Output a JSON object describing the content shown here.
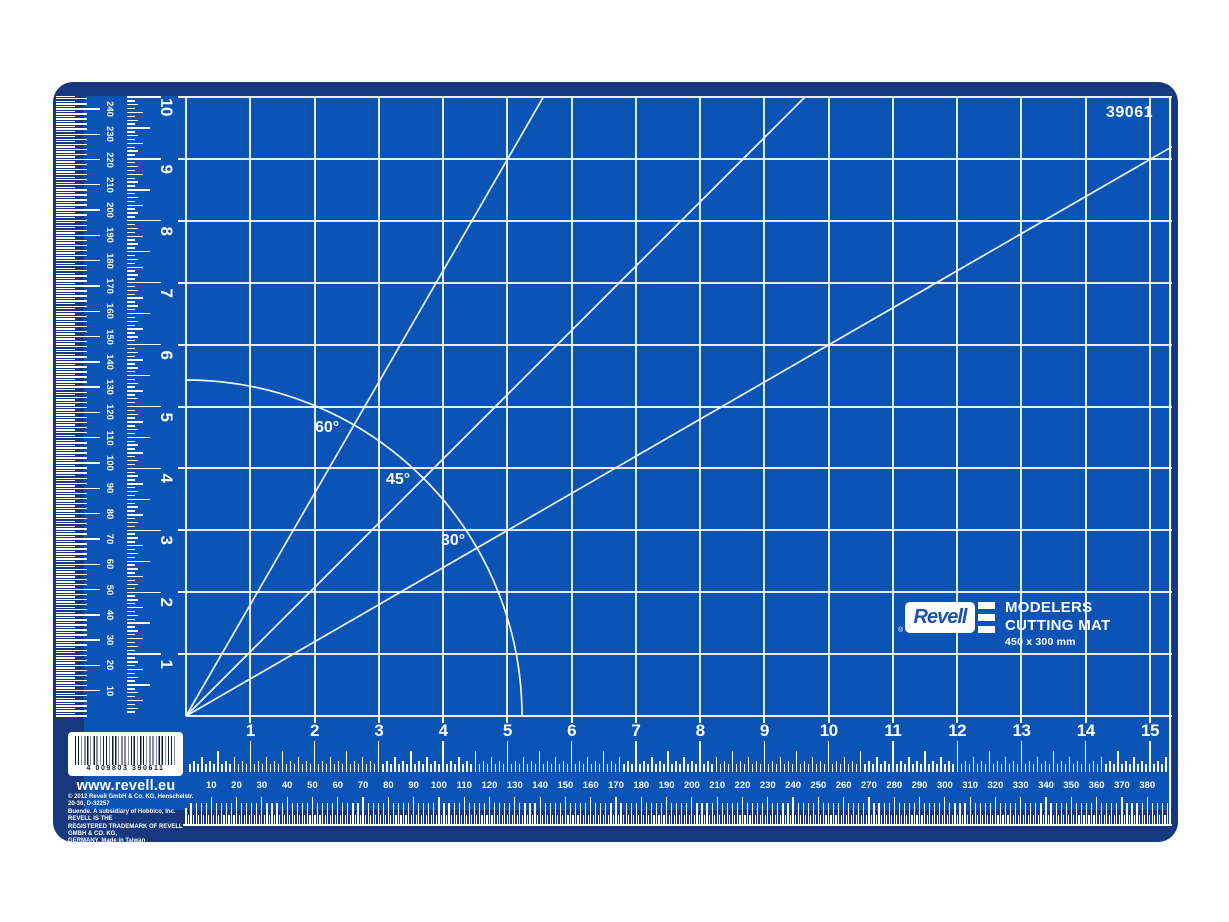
{
  "product": {
    "code": "39061",
    "brand": "Revell",
    "reg_mark": "®",
    "title_line1": "MODELERS",
    "title_line2": "CUTTING MAT",
    "size_label": "450 x 300 mm",
    "website": "www.revell.eu",
    "barcode_digits": "4 009803 390611",
    "copyright_lines": [
      "© 2012 Revell GmbH & Co. KG, Henschelstr. 20-30, D-32257",
      "Buende. A subsidiary of Hobbico, Inc. REVELL IS THE",
      "REGISTERED TRADEMARK OF REVELL GMBH & CO. KG,",
      "GERMANY. Made in Taiwan"
    ]
  },
  "angle_labels": [
    {
      "label": "60°"
    },
    {
      "label": "45°"
    },
    {
      "label": "30°"
    }
  ],
  "rulers": {
    "inch_bottom": {
      "numbers": [
        1,
        2,
        3,
        4,
        5,
        6,
        7,
        8,
        9,
        10,
        11,
        12,
        13,
        14,
        15
      ]
    },
    "inch_left": {
      "numbers": [
        1,
        2,
        3,
        4,
        5,
        6,
        7,
        8,
        9,
        10
      ]
    },
    "mm_bottom": {
      "numbers": [
        10,
        20,
        30,
        40,
        50,
        60,
        70,
        80,
        90,
        100,
        110,
        120,
        130,
        140,
        150,
        160,
        170,
        180,
        190,
        200,
        210,
        220,
        230,
        240,
        250,
        260,
        270,
        280,
        290,
        300,
        310,
        320,
        330,
        340,
        350,
        360,
        370,
        380
      ]
    },
    "mm_left": {
      "numbers": [
        10,
        20,
        30,
        40,
        50,
        60,
        70,
        80,
        90,
        100,
        110,
        120,
        130,
        140,
        150,
        160,
        170,
        180,
        190,
        200,
        210,
        220,
        230,
        240
      ]
    }
  },
  "colors": {
    "mat_blue": "#0B53B4",
    "border_blue": "#17387D",
    "line_white": "#EEF4FD",
    "logo_blue": "#1C52AC"
  }
}
